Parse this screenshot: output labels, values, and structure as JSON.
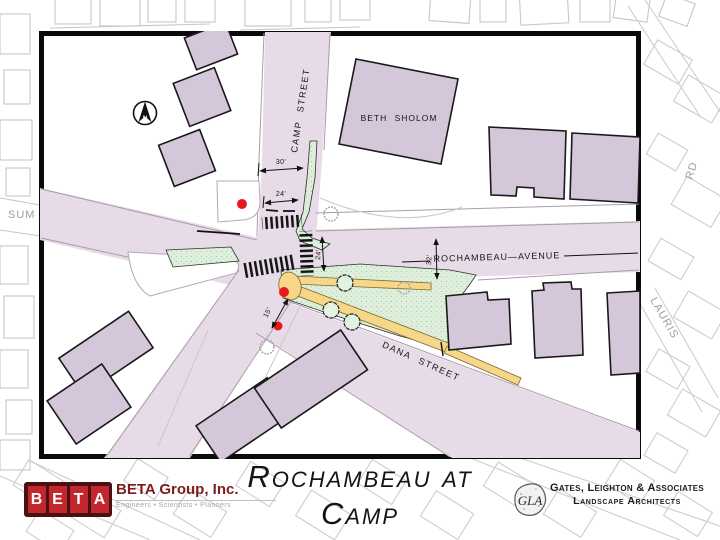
{
  "plan": {
    "north_marker": "N",
    "labels": {
      "camp_street": "CAMP STREET",
      "rochambeau_avenue": "ROCHAMBEAU—AVENUE",
      "dana_street": "DANA STREET",
      "beth_sholom": "BETH SHOLOM"
    },
    "dimensions": {
      "camp_row_width": "30'",
      "camp_pavement_width": "24'",
      "east_crosswalk_width": "24'",
      "rochambeau_width": "32'",
      "island_width": "15'"
    },
    "colors": {
      "street_fill": "#e7dbe7",
      "building_fill": "#d4c7d9",
      "island_green": "#def0dc",
      "walkway_yellow": "#f6d78a",
      "signal_red": "#e8191c"
    }
  },
  "context_map": {
    "labels": {
      "summit": "SUM",
      "rd": "RD",
      "lauriston": "LAURIS"
    }
  },
  "footer": {
    "title_line1": "Rochambeau at",
    "title_line2": "Camp",
    "beta": {
      "letters": [
        "B",
        "E",
        "T",
        "A"
      ],
      "company": "BETA Group, Inc.",
      "tagline": "Engineers • Scientists • Planners"
    },
    "gla": {
      "monogram": "GLA",
      "company": "Gates, Leighton & Associates",
      "subtitle": "Landscape Architects"
    }
  }
}
